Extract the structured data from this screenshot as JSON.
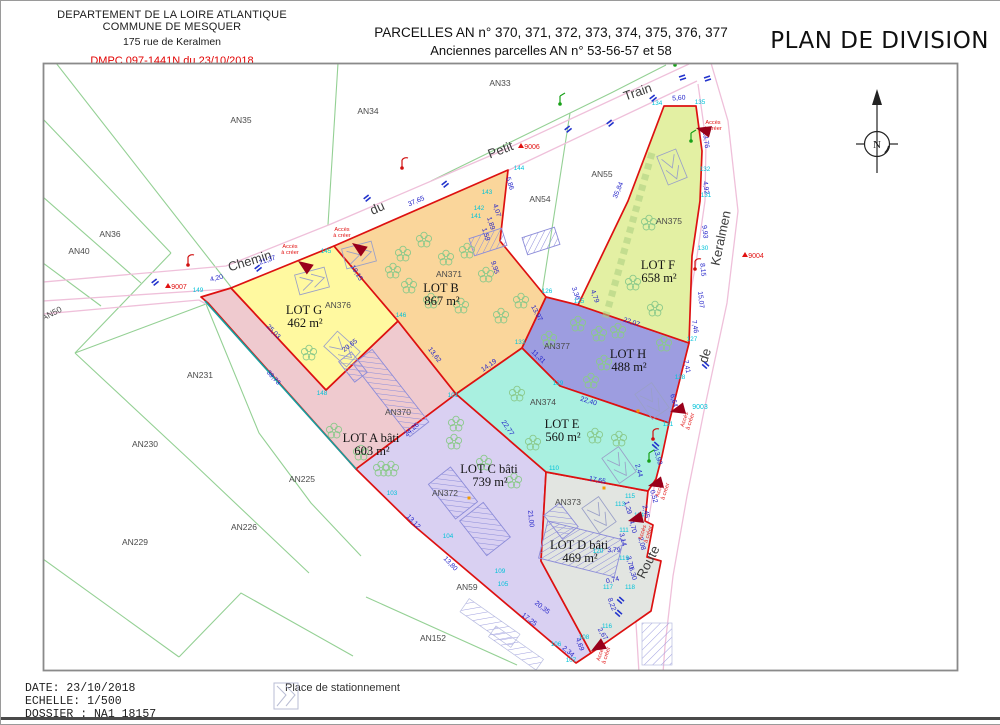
{
  "header": {
    "left_line1": "DEPARTEMENT DE LA LOIRE ATLANTIQUE",
    "left_line2": "COMMUNE DE MESQUER",
    "left_line3": "175 rue de Keralmen",
    "dmpc": "DMPC 097-1441N du 23/10/2018",
    "title_line1": "PARCELLES AN n° 370, 371, 372, 373, 374, 375, 376, 377",
    "title_line2": "Anciennes parcelles AN n° 53-56-57 et 58",
    "plan_title": "PLAN DE DIVISION"
  },
  "footer": {
    "date_label": "DATE: 23/10/2018",
    "scale_label": "ECHELLE: 1/500",
    "file_label": "DOSSIER : NA1 18157",
    "legend_parking": "Place de stationnement"
  },
  "compass": {
    "north_label": "N"
  },
  "colors": {
    "lot_border": "#dd1111",
    "green_line": "#94d094",
    "road_pink": "#efc0da",
    "teal_line": "#169f9f",
    "building": "#8c8cd9",
    "tree": "#8bc98b",
    "parking": "#9aa0c8",
    "marker_red": "#e11111",
    "marker_cyan": "#00c2d8",
    "triangle": "#99001a",
    "blue_mark": "#2233cc",
    "orange_dot": "#f59b00"
  },
  "map": {
    "access_label": "Accès à créer",
    "lots": [
      {
        "id": "A",
        "name": "LOT A bâti",
        "area": "603 m²",
        "color": "#EFCACF",
        "lx": 370,
        "ly": 441,
        "poly": "200,296 230,287 325,389 397,320 455,393 355,468 207,302"
      },
      {
        "id": "C",
        "name": "LOT C bâti",
        "area": "739 m²",
        "color": "#D9D0F2",
        "lx": 488,
        "ly": 472,
        "poly": "455,393 545,471 540,560 590,652 575,662 411,523 355,468"
      },
      {
        "id": "D",
        "name": "LOT D bâti",
        "area": "469 m²",
        "color": "#E2E5E1",
        "lx": 578,
        "ly": 548,
        "poly": "545,471 647,490 644,520 652,524 646,556 660,560 650,610 590,652 540,560"
      },
      {
        "id": "G",
        "name": "LOT G",
        "area": "462 m²",
        "color": "#FFF9A0",
        "lx": 303,
        "ly": 313,
        "poly": "230,287 333,245 397,320 325,389"
      },
      {
        "id": "B",
        "name": "LOT B",
        "area": "867 m²",
        "color": "#FAD69B",
        "lx": 440,
        "ly": 291,
        "poly": "333,245 507,169 499,240 545,296 521,347 455,393 397,320"
      },
      {
        "id": "H",
        "name": "LOT H",
        "area": "488 m²",
        "color": "#9D9DE0",
        "lx": 627,
        "ly": 357,
        "poly": "545,296 577,304 688,342 668,422 559,385 521,347"
      },
      {
        "id": "E",
        "name": "LOT E",
        "area": "560 m²",
        "color": "#A9F0E0",
        "lx": 561,
        "ly": 427,
        "poly": "455,393 521,347 559,385 668,422 661,455 655,478 647,490 545,471"
      },
      {
        "id": "F",
        "name": "LOT F",
        "area": "658 m²",
        "color": "#E3F0A3",
        "lx": 657,
        "ly": 268,
        "poly": "663,105 695,105 701,150 699,200 691,255 688,342 577,304 627,200"
      }
    ],
    "parcel_labels": [
      {
        "t": "AN33",
        "x": 499,
        "y": 85
      },
      {
        "t": "AN34",
        "x": 367,
        "y": 113
      },
      {
        "t": "AN35",
        "x": 240,
        "y": 122
      },
      {
        "t": "AN36",
        "x": 109,
        "y": 236
      },
      {
        "t": "AN40",
        "x": 78,
        "y": 253
      },
      {
        "t": "AN50",
        "x": 52,
        "y": 315,
        "r": -27
      },
      {
        "t": "AN231",
        "x": 199,
        "y": 377
      },
      {
        "t": "AN230",
        "x": 144,
        "y": 446
      },
      {
        "t": "AN229",
        "x": 134,
        "y": 544
      },
      {
        "t": "AN226",
        "x": 243,
        "y": 529
      },
      {
        "t": "AN225",
        "x": 301,
        "y": 481
      },
      {
        "t": "AN55",
        "x": 601,
        "y": 176
      },
      {
        "t": "AN54",
        "x": 539,
        "y": 201
      },
      {
        "t": "AN59",
        "x": 466,
        "y": 589
      },
      {
        "t": "AN152",
        "x": 432,
        "y": 640
      },
      {
        "t": "AN370",
        "x": 397,
        "y": 414
      },
      {
        "t": "AN371",
        "x": 448,
        "y": 276
      },
      {
        "t": "AN372",
        "x": 444,
        "y": 495
      },
      {
        "t": "AN373",
        "x": 567,
        "y": 504
      },
      {
        "t": "AN374",
        "x": 542,
        "y": 404
      },
      {
        "t": "AN375",
        "x": 668,
        "y": 223
      },
      {
        "t": "AN376",
        "x": 337,
        "y": 307
      },
      {
        "t": "AN377",
        "x": 556,
        "y": 348
      }
    ],
    "street_words": [
      {
        "t": "Chemin",
        "x": 250,
        "y": 264,
        "r": -17
      },
      {
        "t": "du",
        "x": 378,
        "y": 211,
        "r": -24
      },
      {
        "t": "Petit",
        "x": 501,
        "y": 153,
        "r": -21
      },
      {
        "t": "Train",
        "x": 638,
        "y": 95,
        "r": -19
      },
      {
        "t": "Keralmen",
        "x": 724,
        "y": 238,
        "r": -78
      },
      {
        "t": "de",
        "x": 708,
        "y": 356,
        "r": -72
      },
      {
        "t": "Route",
        "x": 651,
        "y": 563,
        "r": -63
      }
    ],
    "measurements": [
      {
        "t": "4,20",
        "x": 216,
        "y": 279,
        "r": -14
      },
      {
        "t": "21,37",
        "x": 267,
        "y": 261,
        "r": -19
      },
      {
        "t": "37,65",
        "x": 416,
        "y": 202,
        "r": -23
      },
      {
        "t": "5,60",
        "x": 678,
        "y": 99,
        "r": -4
      },
      {
        "t": "19,15",
        "x": 354,
        "y": 273,
        "r": 58
      },
      {
        "t": "25,03",
        "x": 271,
        "y": 332,
        "r": 46
      },
      {
        "t": "20,65",
        "x": 350,
        "y": 346,
        "r": -37
      },
      {
        "t": "39,73",
        "x": 271,
        "y": 378,
        "r": 47
      },
      {
        "t": "5,86",
        "x": 507,
        "y": 183,
        "r": 72
      },
      {
        "t": "4,07",
        "x": 494,
        "y": 210,
        "r": 72
      },
      {
        "t": "1,89",
        "x": 488,
        "y": 223,
        "r": 72
      },
      {
        "t": "1,59",
        "x": 483,
        "y": 234,
        "r": 72
      },
      {
        "t": "35,84",
        "x": 619,
        "y": 190,
        "r": -67
      },
      {
        "t": "13,97",
        "x": 534,
        "y": 313,
        "r": 62
      },
      {
        "t": "3,36",
        "x": 573,
        "y": 293,
        "r": 70
      },
      {
        "t": "4,79",
        "x": 592,
        "y": 296,
        "r": 70
      },
      {
        "t": "9,95",
        "x": 492,
        "y": 267,
        "r": 72
      },
      {
        "t": "22,07",
        "x": 630,
        "y": 323,
        "r": 18
      },
      {
        "t": "13,76",
        "x": 703,
        "y": 139,
        "r": 82
      },
      {
        "t": "4,92",
        "x": 703,
        "y": 187,
        "r": 82
      },
      {
        "t": "9,93",
        "x": 702,
        "y": 231,
        "r": 84
      },
      {
        "t": "8,15",
        "x": 700,
        "y": 269,
        "r": 84
      },
      {
        "t": "15,07",
        "x": 698,
        "y": 299,
        "r": 84
      },
      {
        "t": "7,46",
        "x": 692,
        "y": 326,
        "r": 80
      },
      {
        "t": "7,41",
        "x": 684,
        "y": 366,
        "r": 78
      },
      {
        "t": "6,64",
        "x": 671,
        "y": 400,
        "r": 75
      },
      {
        "t": "13,93",
        "x": 655,
        "y": 456,
        "r": 74
      },
      {
        "t": "2,44",
        "x": 636,
        "y": 470,
        "r": 74
      },
      {
        "t": "0,52",
        "x": 651,
        "y": 496,
        "r": 74
      },
      {
        "t": "2,45",
        "x": 643,
        "y": 511,
        "r": 76
      },
      {
        "t": "1,29",
        "x": 625,
        "y": 507,
        "r": 76
      },
      {
        "t": "4,70",
        "x": 630,
        "y": 526,
        "r": 76
      },
      {
        "t": "3,14",
        "x": 620,
        "y": 539,
        "r": 76
      },
      {
        "t": "2,08",
        "x": 639,
        "y": 543,
        "r": 76
      },
      {
        "t": "3,70",
        "x": 627,
        "y": 562,
        "r": 76
      },
      {
        "t": "3,79",
        "x": 613,
        "y": 551,
        "r": 0
      },
      {
        "t": "0,74",
        "x": 612,
        "y": 581,
        "r": -12
      },
      {
        "t": "6,30",
        "x": 630,
        "y": 573,
        "r": 74
      },
      {
        "t": "8,22",
        "x": 609,
        "y": 604,
        "r": 70
      },
      {
        "t": "2,67",
        "x": 600,
        "y": 634,
        "r": 58
      },
      {
        "t": "4,69",
        "x": 577,
        "y": 644,
        "r": 70
      },
      {
        "t": "2,34",
        "x": 566,
        "y": 652,
        "r": 40
      },
      {
        "t": "20,35",
        "x": 540,
        "y": 608,
        "r": 38
      },
      {
        "t": "17,25",
        "x": 527,
        "y": 620,
        "r": 38
      },
      {
        "t": "13,80",
        "x": 448,
        "y": 564,
        "r": 46
      },
      {
        "t": "13,12",
        "x": 411,
        "y": 522,
        "r": 46
      },
      {
        "t": "24,26",
        "x": 412,
        "y": 430,
        "r": -41
      },
      {
        "t": "21,00",
        "x": 528,
        "y": 518,
        "r": 84
      },
      {
        "t": "17,65",
        "x": 596,
        "y": 481,
        "r": 11
      },
      {
        "t": "22,40",
        "x": 587,
        "y": 402,
        "r": 17
      },
      {
        "t": "11,31",
        "x": 536,
        "y": 357,
        "r": 44
      },
      {
        "t": "22,77",
        "x": 505,
        "y": 428,
        "r": 56
      },
      {
        "t": "14,19",
        "x": 489,
        "y": 366,
        "r": -35
      },
      {
        "t": "13,62",
        "x": 432,
        "y": 355,
        "r": 52
      }
    ],
    "points": [
      {
        "t": "149",
        "x": 197,
        "y": 291
      },
      {
        "t": "145",
        "x": 325,
        "y": 252
      },
      {
        "t": "146",
        "x": 400,
        "y": 316
      },
      {
        "t": "148",
        "x": 321,
        "y": 394
      },
      {
        "t": "101",
        "x": 452,
        "y": 396
      },
      {
        "t": "144",
        "x": 518,
        "y": 169
      },
      {
        "t": "143",
        "x": 486,
        "y": 193
      },
      {
        "t": "142",
        "x": 478,
        "y": 209
      },
      {
        "t": "141",
        "x": 475,
        "y": 217
      },
      {
        "t": "134",
        "x": 656,
        "y": 104
      },
      {
        "t": "135",
        "x": 699,
        "y": 103
      },
      {
        "t": "132",
        "x": 704,
        "y": 170
      },
      {
        "t": "131",
        "x": 705,
        "y": 196
      },
      {
        "t": "130",
        "x": 702,
        "y": 249
      },
      {
        "t": "127",
        "x": 691,
        "y": 340
      },
      {
        "t": "128",
        "x": 679,
        "y": 378
      },
      {
        "t": "126",
        "x": 546,
        "y": 292
      },
      {
        "t": "125",
        "x": 578,
        "y": 302
      },
      {
        "t": "133",
        "x": 519,
        "y": 343
      },
      {
        "t": "129",
        "x": 557,
        "y": 384
      },
      {
        "t": "121",
        "x": 667,
        "y": 425
      },
      {
        "t": "110",
        "x": 553,
        "y": 469
      },
      {
        "t": "120",
        "x": 597,
        "y": 552
      },
      {
        "t": "119",
        "x": 623,
        "y": 559
      },
      {
        "t": "117",
        "x": 607,
        "y": 588
      },
      {
        "t": "118",
        "x": 629,
        "y": 588
      },
      {
        "t": "115",
        "x": 629,
        "y": 497
      },
      {
        "t": "114",
        "x": 638,
        "y": 516
      },
      {
        "t": "113",
        "x": 619,
        "y": 505
      },
      {
        "t": "111",
        "x": 623,
        "y": 531
      },
      {
        "t": "116",
        "x": 606,
        "y": 627
      },
      {
        "t": "109",
        "x": 499,
        "y": 572
      },
      {
        "t": "105",
        "x": 502,
        "y": 585
      },
      {
        "t": "104",
        "x": 447,
        "y": 537
      },
      {
        "t": "103",
        "x": 391,
        "y": 494
      },
      {
        "t": "106",
        "x": 555,
        "y": 645
      },
      {
        "t": "107",
        "x": 570,
        "y": 661
      },
      {
        "t": "108",
        "x": 583,
        "y": 638
      }
    ],
    "markers": [
      {
        "t": "9007",
        "x": 176,
        "y": 286,
        "c": "#e11111",
        "tri": true
      },
      {
        "t": "9006",
        "x": 529,
        "y": 146,
        "c": "#e11111",
        "tri": true
      },
      {
        "t": "9004",
        "x": 753,
        "y": 255,
        "c": "#e11111",
        "tri": true
      },
      {
        "t": "9003",
        "x": 697,
        "y": 406,
        "c": "#00c2d8",
        "tri": false
      }
    ],
    "access_positions": [
      {
        "x": 289,
        "y": 247,
        "r": 0
      },
      {
        "x": 341,
        "y": 230,
        "r": 0
      },
      {
        "x": 712,
        "y": 123,
        "r": 0
      },
      {
        "x": 685,
        "y": 419,
        "r": -72
      },
      {
        "x": 660,
        "y": 489,
        "r": -72
      },
      {
        "x": 643,
        "y": 532,
        "r": -72
      },
      {
        "x": 601,
        "y": 653,
        "r": -72
      }
    ],
    "access_triangles": [
      {
        "x": 297,
        "y": 260,
        "r": 35
      },
      {
        "x": 351,
        "y": 242,
        "r": 35
      },
      {
        "x": 695,
        "y": 127,
        "r": 15
      },
      {
        "x": 669,
        "y": 411,
        "r": -15
      },
      {
        "x": 647,
        "y": 485,
        "r": -15
      },
      {
        "x": 627,
        "y": 520,
        "r": -15
      },
      {
        "x": 590,
        "y": 650,
        "r": -30
      }
    ],
    "trees": [
      [
        308,
        352
      ],
      [
        402,
        253
      ],
      [
        423,
        239
      ],
      [
        445,
        257
      ],
      [
        466,
        250
      ],
      [
        485,
        274
      ],
      [
        430,
        300
      ],
      [
        460,
        305
      ],
      [
        408,
        285
      ],
      [
        500,
        315
      ],
      [
        520,
        300
      ],
      [
        392,
        270
      ],
      [
        648,
        222
      ],
      [
        632,
        282
      ],
      [
        654,
        308
      ],
      [
        617,
        330
      ],
      [
        548,
        338
      ],
      [
        577,
        323
      ],
      [
        598,
        333
      ],
      [
        603,
        362
      ],
      [
        590,
        380
      ],
      [
        663,
        343
      ],
      [
        516,
        393
      ],
      [
        532,
        442
      ],
      [
        594,
        435
      ],
      [
        618,
        438
      ],
      [
        455,
        423
      ],
      [
        453,
        441
      ],
      [
        483,
        462
      ],
      [
        513,
        480
      ],
      [
        390,
        468
      ],
      [
        333,
        430
      ],
      [
        360,
        452
      ],
      [
        380,
        468
      ]
    ],
    "buildings": [
      [
        390,
        392,
        92,
        24,
        52
      ],
      [
        352,
        366,
        26,
        16,
        52
      ],
      [
        452,
        492,
        44,
        28,
        52
      ],
      [
        484,
        528,
        44,
        30,
        52
      ],
      [
        487,
        241,
        34,
        18,
        -18
      ],
      [
        540,
        240,
        34,
        18,
        -18
      ],
      [
        580,
        548,
        78,
        38,
        14
      ],
      [
        560,
        520,
        30,
        20,
        52
      ]
    ],
    "parkings": [
      [
        311,
        280,
        -15
      ],
      [
        341,
        348,
        42
      ],
      [
        358,
        254,
        -15
      ],
      [
        671,
        166,
        68
      ],
      [
        651,
        400,
        55
      ],
      [
        618,
        464,
        55
      ],
      [
        598,
        514,
        55
      ]
    ],
    "paving": [
      [
        489,
        622,
        62,
        16,
        35
      ],
      [
        515,
        647,
        58,
        13,
        35
      ],
      [
        656,
        643,
        30,
        42,
        0
      ]
    ],
    "blue_marks": [
      [
        150,
        280,
        -20
      ],
      [
        253,
        266,
        -20
      ],
      [
        362,
        196,
        -20
      ],
      [
        440,
        182,
        -20
      ],
      [
        563,
        127,
        -20
      ],
      [
        605,
        121,
        -20
      ],
      [
        648,
        96,
        -20
      ],
      [
        678,
        74,
        0
      ],
      [
        703,
        75,
        0
      ],
      [
        705,
        360,
        60
      ],
      [
        620,
        595,
        60
      ],
      [
        618,
        608,
        60
      ],
      [
        655,
        440,
        60
      ]
    ],
    "poles": [
      [
        187,
        264,
        "red"
      ],
      [
        401,
        167,
        "red"
      ],
      [
        559,
        103,
        "green"
      ],
      [
        674,
        64,
        "green"
      ],
      [
        690,
        140,
        "green"
      ],
      [
        694,
        268,
        "red"
      ],
      [
        648,
        460,
        "green"
      ],
      [
        652,
        438,
        "red"
      ]
    ],
    "orange_dots": [
      [
        468,
        497
      ],
      [
        603,
        487
      ],
      [
        637,
        410
      ]
    ]
  }
}
